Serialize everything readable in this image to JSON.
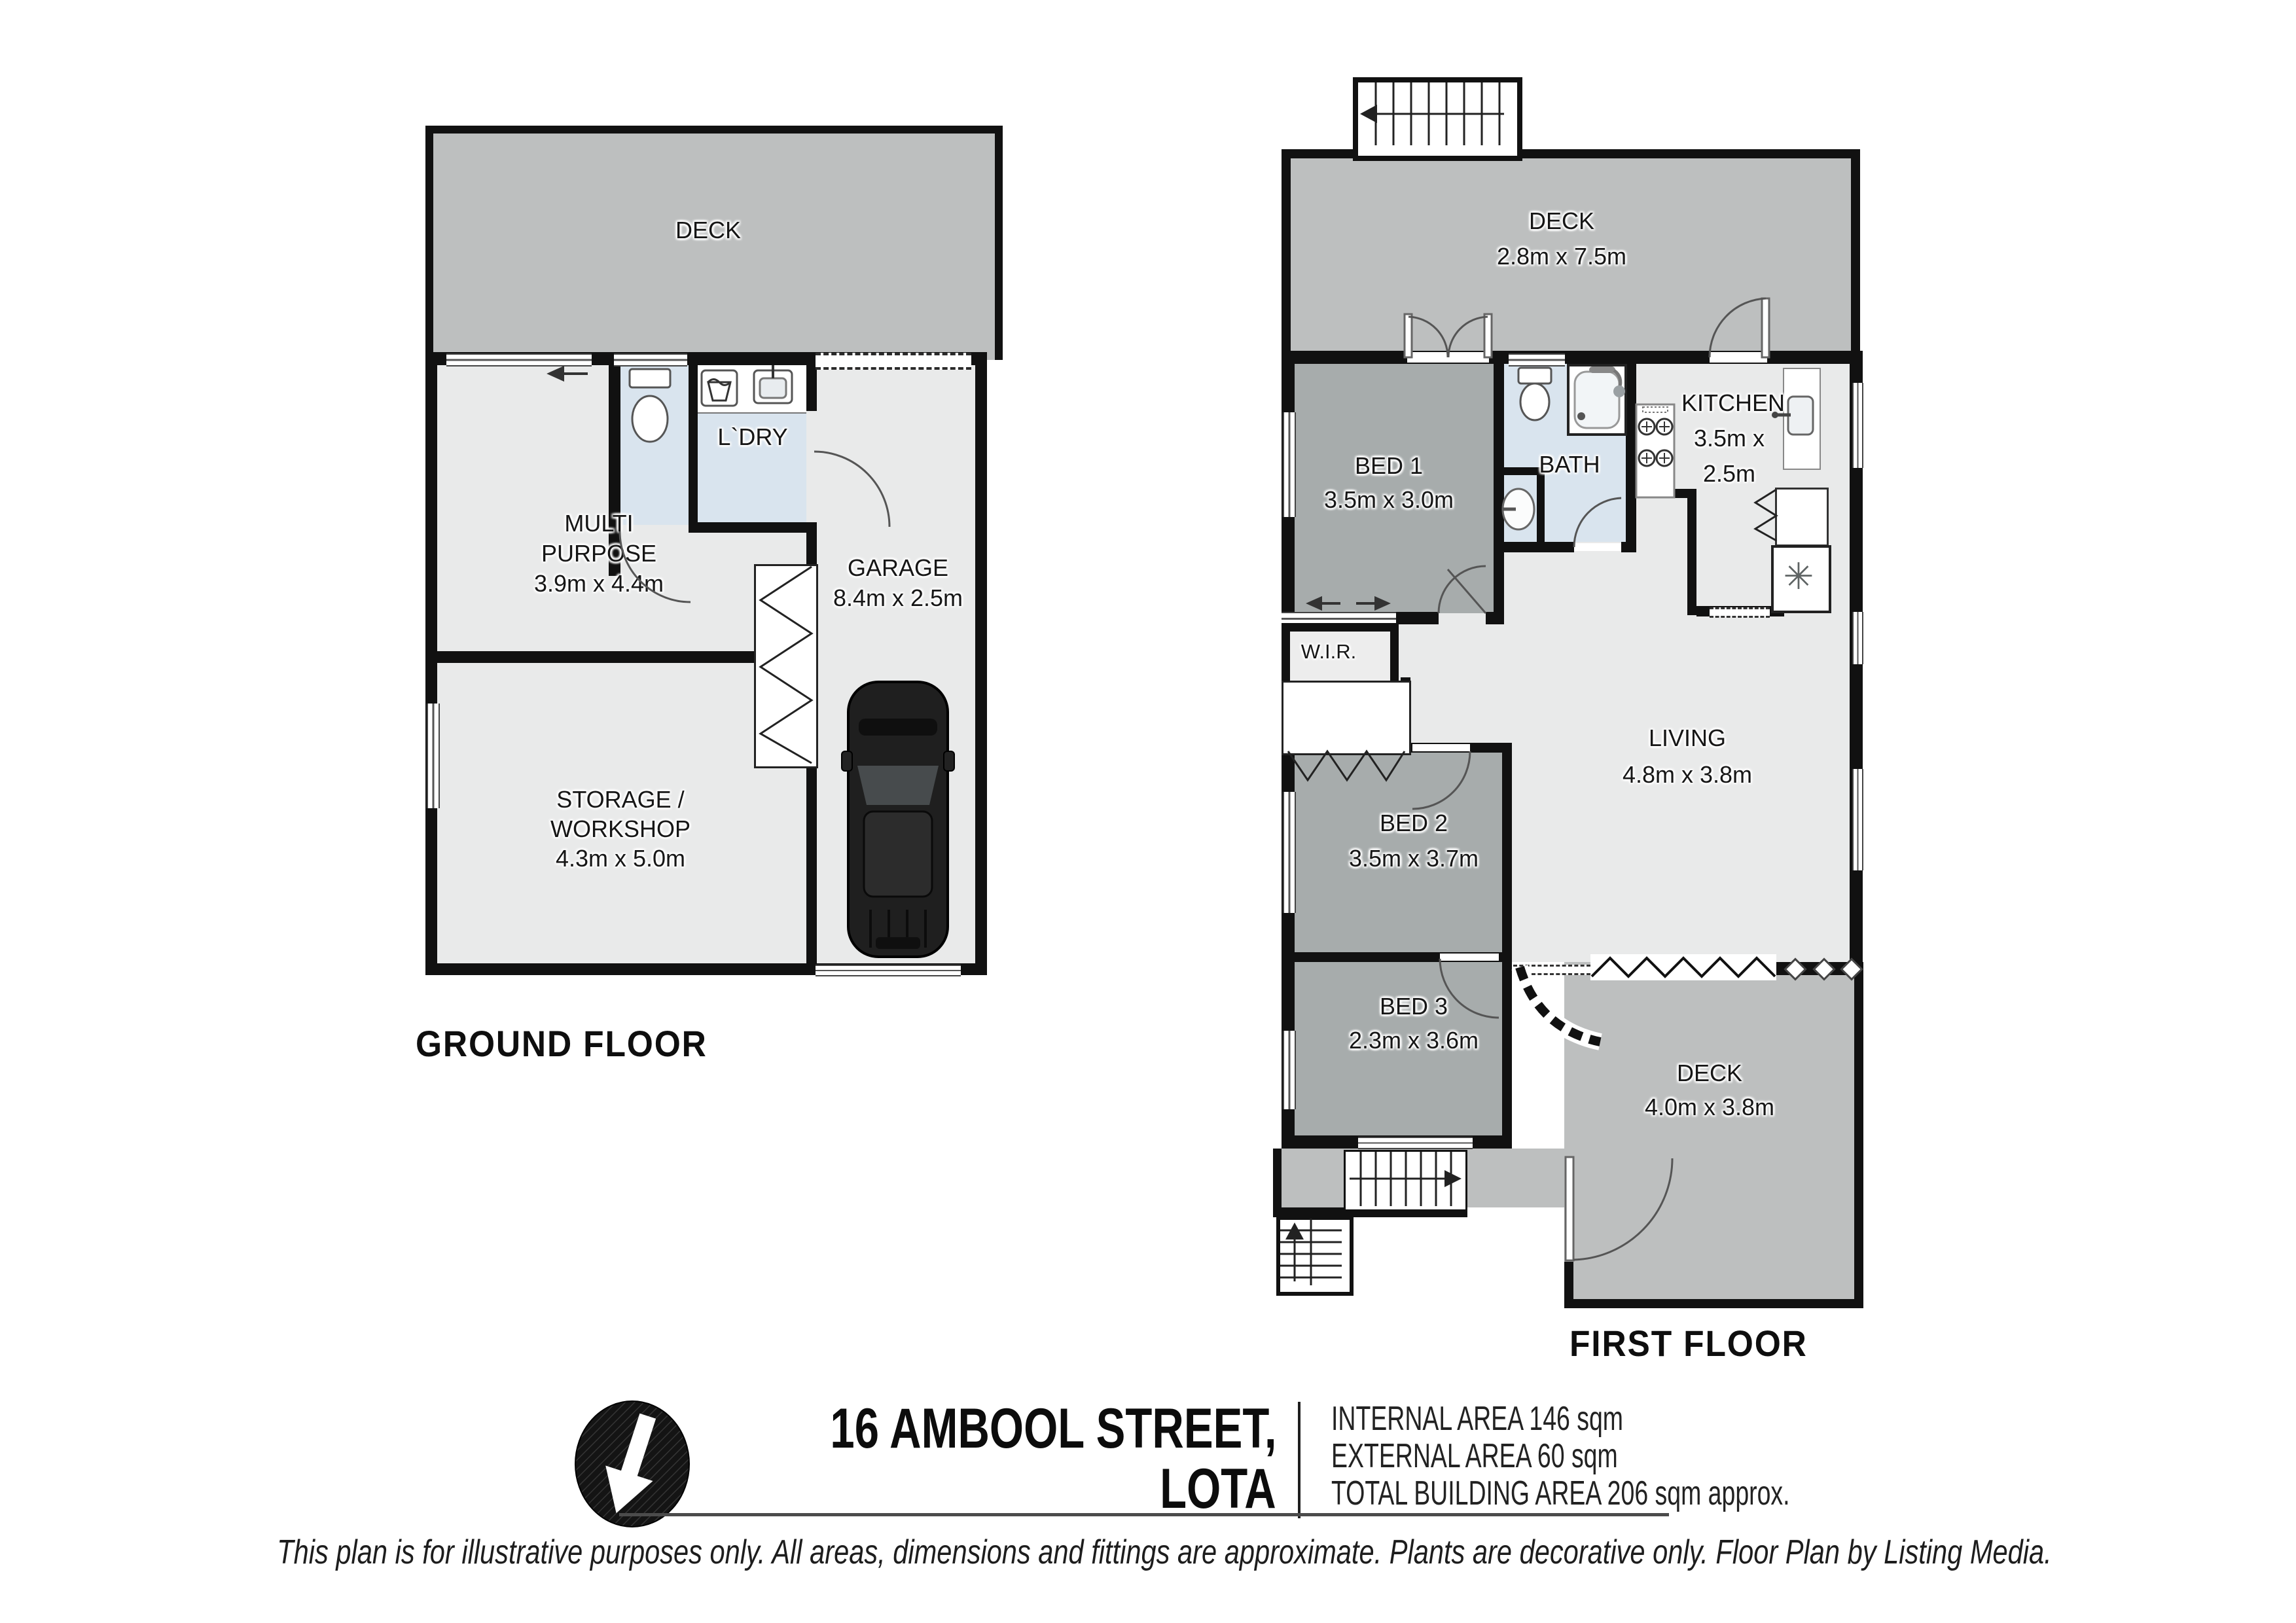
{
  "ground_floor": {
    "floor_label": "GROUND FLOOR",
    "deck": {
      "name": "DECK"
    },
    "multi_purpose": {
      "name_line1": "MULTI",
      "name_line2": "PURPOSE",
      "dims": "3.9m x 4.4m"
    },
    "laundry": {
      "name": "L`DRY"
    },
    "garage": {
      "name": "GARAGE",
      "dims": "8.4m x 2.5m"
    },
    "storage": {
      "name_line1": "STORAGE /",
      "name_line2": "WORKSHOP",
      "dims": "4.3m x 5.0m"
    }
  },
  "first_floor": {
    "floor_label": "FIRST FLOOR",
    "deck_top": {
      "name": "DECK",
      "dims": "2.8m x 7.5m"
    },
    "bed1": {
      "name": "BED 1",
      "dims": "3.5m x 3.0m"
    },
    "bath": {
      "name": "BATH"
    },
    "kitchen": {
      "name": "KITCHEN",
      "dims_line1": "3.5m x",
      "dims_line2": "2.5m"
    },
    "wir": {
      "name": "W.I.R."
    },
    "bed2": {
      "name": "BED 2",
      "dims": "3.5m x 3.7m"
    },
    "living": {
      "name": "LIVING",
      "dims": "4.8m x 3.8m"
    },
    "bed3": {
      "name": "BED 3",
      "dims": "2.3m x 3.6m"
    },
    "deck_bottom": {
      "name": "DECK",
      "dims": "4.0m x 3.8m"
    }
  },
  "footer": {
    "address_line1": "16 AMBOOL STREET,",
    "address_line2": "LOTA",
    "area_internal": "INTERNAL AREA 146 sqm",
    "area_external": "EXTERNAL AREA 60 sqm",
    "area_total": "TOTAL BUILDING AREA 206 sqm approx.",
    "disclaimer": "This plan is for illustrative purposes only. All areas, dimensions and fittings are approximate. Plants are decorative only. Floor Plan by Listing Media."
  },
  "symbols": {
    "fridge": "✳"
  },
  "colors": {
    "wall": "#111111",
    "deck": "#bdbfbf",
    "room_dark": "#a7acac",
    "floor_light": "#e9eaea",
    "wet_blue": "#d9e4ee"
  }
}
